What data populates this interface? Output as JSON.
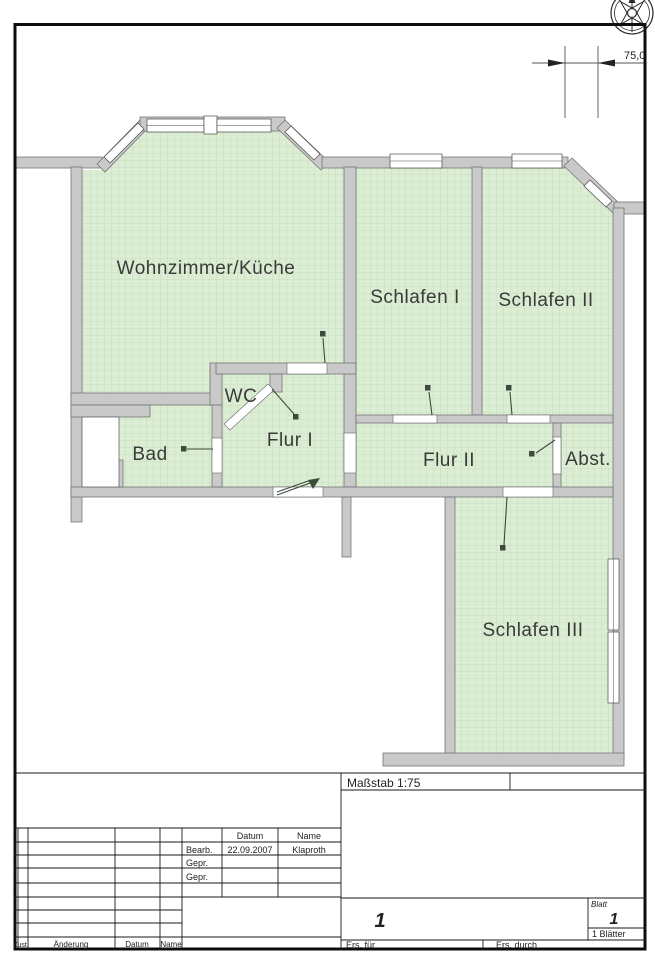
{
  "drawing": {
    "type": "floor-plan",
    "dimension_label": "75,0"
  },
  "colors": {
    "room_fill": "#dbeed4",
    "room_grid": "#cde2c6",
    "wall_fill": "#c9c9c9",
    "wall_outline": "#757575",
    "border": "#0d0d0d",
    "label": "#3a3a3a"
  },
  "rooms": [
    {
      "id": "wohnzimmer",
      "label": "Wohnzimmer/Küche"
    },
    {
      "id": "schlafen1",
      "label": "Schlafen I"
    },
    {
      "id": "schlafen2",
      "label": "Schlafen II"
    },
    {
      "id": "wc",
      "label": "WC"
    },
    {
      "id": "bad",
      "label": "Bad"
    },
    {
      "id": "flur1",
      "label": "Flur I"
    },
    {
      "id": "flur2",
      "label": "Flur II"
    },
    {
      "id": "abst",
      "label": "Abst."
    },
    {
      "id": "schlafen3",
      "label": "Schlafen III"
    }
  ],
  "title_block": {
    "massstab": "Maßstab 1:75",
    "header_datum": "Datum",
    "header_name": "Name",
    "row_bearb_label": "Bearb.",
    "row_bearb_datum": "22.09.2007",
    "row_bearb_name": "Klaproth",
    "row_gepr1_label": "Gepr.",
    "row_gepr2_label": "Gepr.",
    "sheet_number": "1",
    "blatt_label": "Blatt",
    "blatt_value": "1",
    "blaetter": "1 Blätter",
    "ers_fuer": "Ers. für",
    "ers_durch": "Ers. durch",
    "rev_zust": "Zust.",
    "rev_aenderung": "Änderung",
    "rev_datum": "Datum",
    "rev_name": "Name"
  }
}
